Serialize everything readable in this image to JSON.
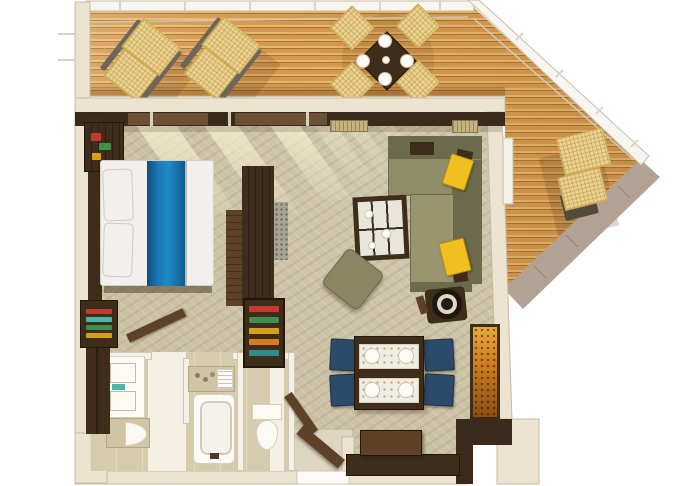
{
  "meta": {
    "title": "3D top-down floor plan of a suite with wrap-around balcony deck",
    "view": "overhead 3D architectural render",
    "visible_text": "none"
  },
  "palette": {
    "deckPlank": "#d69a51",
    "deckPlankLight": "#e7b96e",
    "deckPlankGap": "#a9762f",
    "hull": "#b2a294",
    "hullSeam": "#94846f",
    "railing": "#f7f5ee",
    "railingEdge": "#c6c0b1",
    "wallCream": "#ece4d1",
    "wallEdge": "#c6bba3",
    "wallDark": "#3a2a1c",
    "carpet": "#cac1a4",
    "tile": "#d7cbae",
    "tileWhite": "#f4f0e3",
    "woodDark": "#3f2d1b",
    "woodMid": "#5d4227",
    "bedWhite": "#f2f0ec",
    "runnerBlue": "#1777b0",
    "runnerBlueDeep": "#0d4f7e",
    "sofa": "#8f8c68",
    "sofaDark": "#6c6a4c",
    "pillowYellow": "#f0c01f",
    "chairNavy": "#2c4b6b",
    "porcelain": "#fbfaf5",
    "counterBeige": "#cfc4a4",
    "artOrange": "#cf7d22",
    "wicker": "#ecd28d",
    "wickerEdge": "#c9a74e",
    "accentTeal": "#49b8a8",
    "accentRed": "#c23b2e",
    "accentGreen": "#3f8f4f",
    "accentAmber": "#d4a017"
  },
  "rooms": [
    {
      "id": "balcony-deck",
      "label": "Balcony deck"
    },
    {
      "id": "bedroom",
      "label": "Bedroom"
    },
    {
      "id": "living-room",
      "label": "Living room"
    },
    {
      "id": "dining-area",
      "label": "Dining area"
    },
    {
      "id": "bathroom",
      "label": "Bathroom"
    },
    {
      "id": "wc",
      "label": "Toilet room"
    },
    {
      "id": "entry",
      "label": "Entry hall"
    }
  ],
  "items": {
    "deck": {
      "label": "Teak balcony deck"
    },
    "railing": {
      "label": "White deck railing"
    },
    "hull": {
      "label": "Hull edge band"
    },
    "lounger": {
      "label": "Sun lounger"
    },
    "outdoor_table": {
      "label": "Outdoor dining table set for four"
    },
    "outdoor_chair": {
      "label": "Wicker deck chair"
    },
    "bed": {
      "label": "Bed with white duvet and blue runner"
    },
    "pillow": {
      "label": "Bed pillow"
    },
    "headboard": {
      "label": "Headboard wall panel"
    },
    "nightstand": {
      "label": "Nightstand with flowers"
    },
    "bookshelf": {
      "label": "Bedside shelf with books"
    },
    "wardrobe": {
      "label": "Wardrobe divider unit"
    },
    "minibar": {
      "label": "Open shelf unit with minibar items"
    },
    "bedroom_door": {
      "label": "Bedroom door (open)"
    },
    "closet": {
      "label": "Closet"
    },
    "vanity": {
      "label": "Vanity with twin basins"
    },
    "sink": {
      "label": "Washbasin"
    },
    "tub": {
      "label": "Bathtub"
    },
    "tub_counter": {
      "label": "Bath counter with toiletries"
    },
    "toilet": {
      "label": "Toilet"
    },
    "wc_door": {
      "label": "Toilet room door (open)"
    },
    "entry_door": {
      "label": "Entry door (open)"
    },
    "sofa": {
      "label": "L-shaped sectional sofa"
    },
    "sofa_pillow": {
      "label": "Yellow accent pillow"
    },
    "coffee_table": {
      "label": "Glass-top coffee table"
    },
    "pouf": {
      "label": "Ottoman pouf"
    },
    "barrel_chair": {
      "label": "Swivel barrel chair"
    },
    "dining_table": {
      "label": "Dining table set for four"
    },
    "dining_chair": {
      "label": "Navy dining chair"
    },
    "artwork": {
      "label": "Orange decorative art panel"
    },
    "tv_console": {
      "label": "TV console"
    },
    "vent": {
      "label": "Rattan vent panel"
    },
    "light_shaft": {
      "label": "Window light on carpet"
    }
  },
  "counts": {
    "sun_loungers": 3,
    "outdoor_chairs": 4,
    "outdoor_plates": 4,
    "dining_chairs": 4,
    "dining_plates": 4,
    "bathroom_basins": 3
  }
}
